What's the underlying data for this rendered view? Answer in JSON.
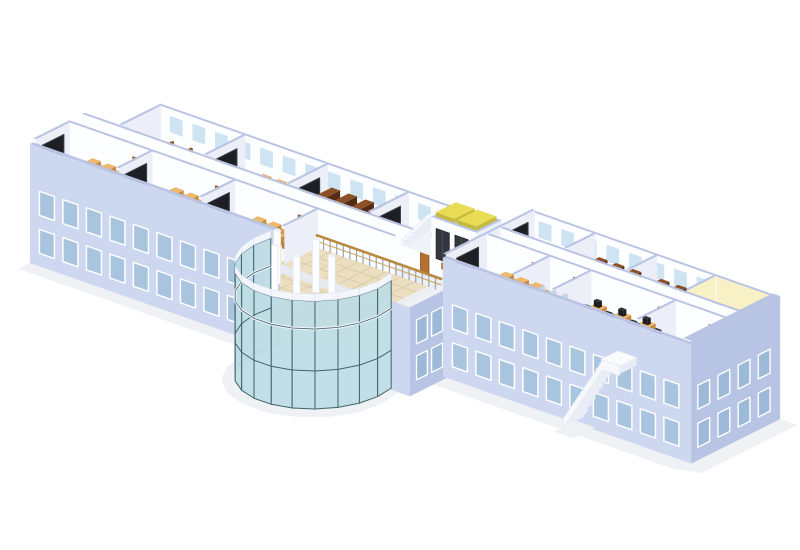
{
  "meta": {
    "background": "#ffffff",
    "kind": "isometric-building-cutaway-rendering"
  },
  "scene": {
    "iso": {
      "e": [
        0.94,
        0.33
      ],
      "n": [
        0.84,
        -0.42
      ],
      "origin": [
        30,
        178
      ],
      "wallH": 38,
      "facadeTopZ": 34,
      "groundZ": -85
    },
    "palette": {
      "wallTop": "#b9c4e4",
      "faceSW": "#fdfeff",
      "faceSE": "#eceff7",
      "facadeSW": "#cdd7ef",
      "facadeSE": "#b8c4e4",
      "win": "#a9c4de",
      "winFrame": "#ffffff",
      "winBack": "#cfe4f3",
      "base": "#f2f2f5",
      "floorRoom": "#faf6ef",
      "floorSalmon": "#f7e8da",
      "floorCorr": "#eef0f4",
      "corrLine": "#e2e6ee",
      "floorLab": "#f0f1f4",
      "floorWash": "#f3f6fa",
      "floorOffice": "#faf2bd",
      "floorStore": "#f7f4ee",
      "atrFloor": "#ecdfc1",
      "atrLine": "#d9cba4",
      "glass": "#bedde4",
      "mullion": "#41636c",
      "ring": "#f3f6fb",
      "deskT": "#edb76c",
      "deskF": "#d99e54",
      "deskS": "#c48a40",
      "chairT": "#da9b52",
      "chairF": "#b97f3c",
      "teachT": "#8d4a28",
      "teachF": "#7a3c1f",
      "teachS": "#6b3319",
      "board": "#1d1f24",
      "boardFrame": "#3c4048",
      "shelfT": "#8a5026",
      "shelfF": "#64361a",
      "shelfS": "#532a12",
      "benchT": "#c07a38",
      "benchF": "#a96329",
      "benchS": "#8f521f",
      "monT": "#2e3138",
      "monF": "#1b1d22",
      "blkT": "#2c2e34",
      "blkF": "#212329",
      "door": "#b4702e",
      "elevDoor": "#35373f",
      "elevTop": "#e9dc55",
      "elevTopS": "#c5b93e",
      "stair": "#fafbfe",
      "stairEdge": "#e2e7f0",
      "riser": "#e9edf5",
      "parapet": "#f6f8fc",
      "rail": "#b8893f",
      "railMid": "#c9a05a",
      "post": "#9aa2b8",
      "officeWallT": "#efe7ac",
      "officeWallF": "#f8f1c6",
      "officeWallS": "#e8dfa0",
      "plant": "#2e7d32",
      "pot": "#a35f2a",
      "redChair": "#d04030",
      "offMon": "#15655f",
      "washT": "#c6d6e6",
      "washF": "#d7e4f0",
      "column": "#fcfdff",
      "columnEdge": "#e1e5ee",
      "columnTop": "#eef1f7",
      "shadow": "#ebedf1"
    },
    "leftBack": {
      "name": "left-back-block",
      "u": [
        36,
        382
      ],
      "v": [
        66,
        112
      ],
      "frontWallV": 62,
      "backWallV": 112,
      "endWall": 378,
      "frontDoors": [
        108,
        196,
        282,
        360
      ],
      "backWins": 12,
      "rooms": [
        {
          "name": "lecture-room",
          "type": "lecture",
          "u": [
            40,
            126
          ],
          "wall": 36,
          "board": false
        },
        {
          "name": "classroom-b1",
          "type": "classroom",
          "u": [
            130,
            214
          ],
          "wall": 126,
          "board": true
        },
        {
          "name": "library-b",
          "type": "library",
          "u": [
            218,
            300
          ],
          "wall": 214,
          "board": true
        },
        {
          "name": "classroom-b2",
          "type": "classroom",
          "u": [
            304,
            378
          ],
          "wall": 300,
          "board": true
        }
      ]
    },
    "leftFront": {
      "name": "left-front-block",
      "u": [
        0,
        348
      ],
      "v": [
        4,
        44
      ],
      "backWallV": 44,
      "endWall": 264,
      "facadeU": [
        0,
        262
      ],
      "backDoors": [
        70,
        158,
        246
      ],
      "rooms": [
        {
          "name": "classroom-a1",
          "type": "classroom",
          "u": [
            4,
            88
          ],
          "wall": 0,
          "board": true
        },
        {
          "name": "classroom-a2",
          "type": "classroom",
          "u": [
            92,
            176
          ],
          "wall": 88,
          "board": true
        },
        {
          "name": "classroom-a3",
          "type": "classroom",
          "u": [
            180,
            264
          ],
          "wall": 176,
          "board": true
        }
      ]
    },
    "corridorA": {
      "name": "main-corridor",
      "u": [
        0,
        384
      ],
      "v": [
        44,
        66
      ]
    },
    "connector": {
      "name": "connector-bridge",
      "u": [
        348,
        404
      ],
      "v": [
        0,
        120
      ],
      "elevator": {
        "name": "elevator-core",
        "u": [
          352,
          400
        ],
        "v": [
          84,
          114
        ],
        "doors": [
          357,
          377
        ]
      },
      "stair": {
        "name": "interior-staircase",
        "u": [
          316,
          348
        ],
        "v": [
          88,
          112
        ]
      },
      "railing": {
        "name": "balcony-railing",
        "v": 44,
        "u": [
          266,
          398
        ]
      },
      "stubFacade": {
        "u": [
          384,
          404
        ]
      }
    },
    "atrium": {
      "name": "glass-atrium",
      "center": [
        322,
        -18
      ],
      "r": 66,
      "glassDeg": [
        166,
        374
      ],
      "glassTopZ": 26,
      "patch": [
        262,
        0,
        384,
        44
      ],
      "columns": [
        [
          287,
          -27
        ],
        [
          304,
          -49
        ],
        [
          331,
          -53
        ],
        [
          353,
          -36
        ],
        [
          322,
          -20
        ]
      ]
    },
    "rightWing": {
      "name": "right-wing",
      "u": [
        400,
        664
      ],
      "v": [
        44,
        150
      ],
      "wWall": 400,
      "eWall": 656,
      "midWall1V": 92,
      "midWall2V": 108,
      "backWallV": 146,
      "wBoards": [
        70,
        129
      ],
      "front": {
        "doors": [
          452,
          496,
          586,
          640
        ],
        "walls": [
          468,
          512,
          602
        ],
        "v": [
          48,
          92
        ],
        "rooms": [
          {
            "name": "classroom-r1",
            "type": "classroom",
            "u": [
              404,
              468
            ],
            "floor": "floorSalmon",
            "teach": false
          },
          {
            "name": "washroom",
            "type": "wash",
            "u": [
              472,
              512
            ],
            "floor": "floorWash"
          },
          {
            "name": "computer-lab",
            "type": "lab",
            "u": [
              516,
              602
            ],
            "floor": "floorLab"
          },
          {
            "name": "storeroom",
            "type": "empty",
            "u": [
              606,
              656
            ],
            "floor": "floorStore"
          }
        ]
      },
      "back": {
        "doors": [
          452,
          518,
          580,
          640
        ],
        "walls": [
          468,
          534,
          596
        ],
        "v": [
          112,
          146
        ],
        "rooms": [
          {
            "name": "classroom-r2",
            "type": "classroom",
            "u": [
              404,
              468
            ],
            "floor": "floorRoom",
            "teach": true
          },
          {
            "name": "library-r1",
            "type": "library",
            "u": [
              472,
              534
            ],
            "floor": "floorRoom"
          },
          {
            "name": "library-r2",
            "type": "library",
            "u": [
              538,
              596
            ],
            "floor": "floorRoom"
          },
          {
            "name": "office-cubicles",
            "type": "office",
            "u": [
              600,
              656
            ],
            "floor": "floorOffice"
          }
        ]
      },
      "extStair": {
        "name": "exterior-staircase",
        "uTop": 586,
        "uEnd": 546,
        "v": [
          24,
          44
        ],
        "landing": [
          586,
          606
        ]
      }
    }
  }
}
